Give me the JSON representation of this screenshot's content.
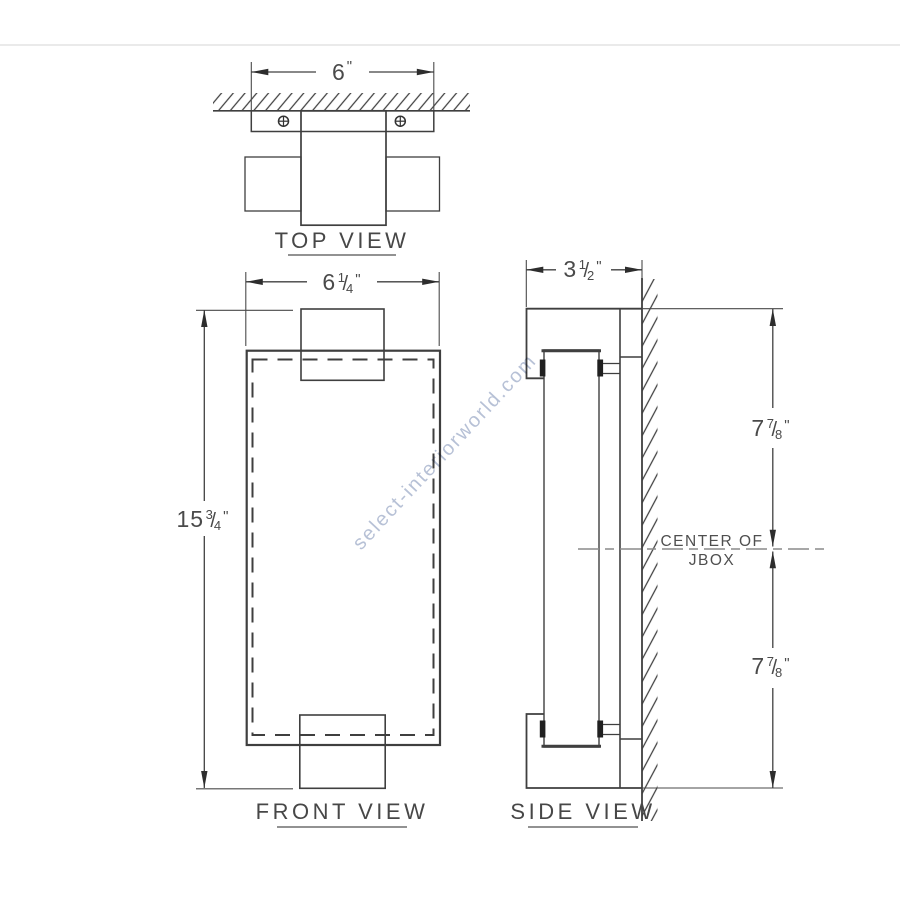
{
  "page": {
    "watermark": "select-interiorworld.com"
  },
  "views": {
    "top": {
      "label": "TOP VIEW"
    },
    "front": {
      "label": "FRONT VIEW"
    },
    "side": {
      "label": "SIDE VIEW"
    }
  },
  "dimensions": {
    "top_width": {
      "whole": "6",
      "num": "",
      "slash": "",
      "den": "",
      "unit": "\""
    },
    "front_width": {
      "whole": "6",
      "num": "1",
      "slash": "/",
      "den": "4",
      "unit": "\""
    },
    "front_height": {
      "whole": "15",
      "num": "3",
      "slash": "/",
      "den": "4",
      "unit": "\""
    },
    "side_depth": {
      "whole": "3",
      "num": "1",
      "slash": "/",
      "den": "2",
      "unit": "\""
    },
    "side_upper": {
      "whole": "7",
      "num": "7",
      "slash": "/",
      "den": "8",
      "unit": "\""
    },
    "side_lower": {
      "whole": "7",
      "num": "7",
      "slash": "/",
      "den": "8",
      "unit": "\""
    }
  },
  "annotations": {
    "jbox_line1": "CENTER OF",
    "jbox_line2": "JBOX"
  },
  "colors": {
    "line": "#3f3f3f",
    "text": "#4a4a4a",
    "watermark": "#b7c1d6",
    "centerline": "#8a8a8a"
  }
}
